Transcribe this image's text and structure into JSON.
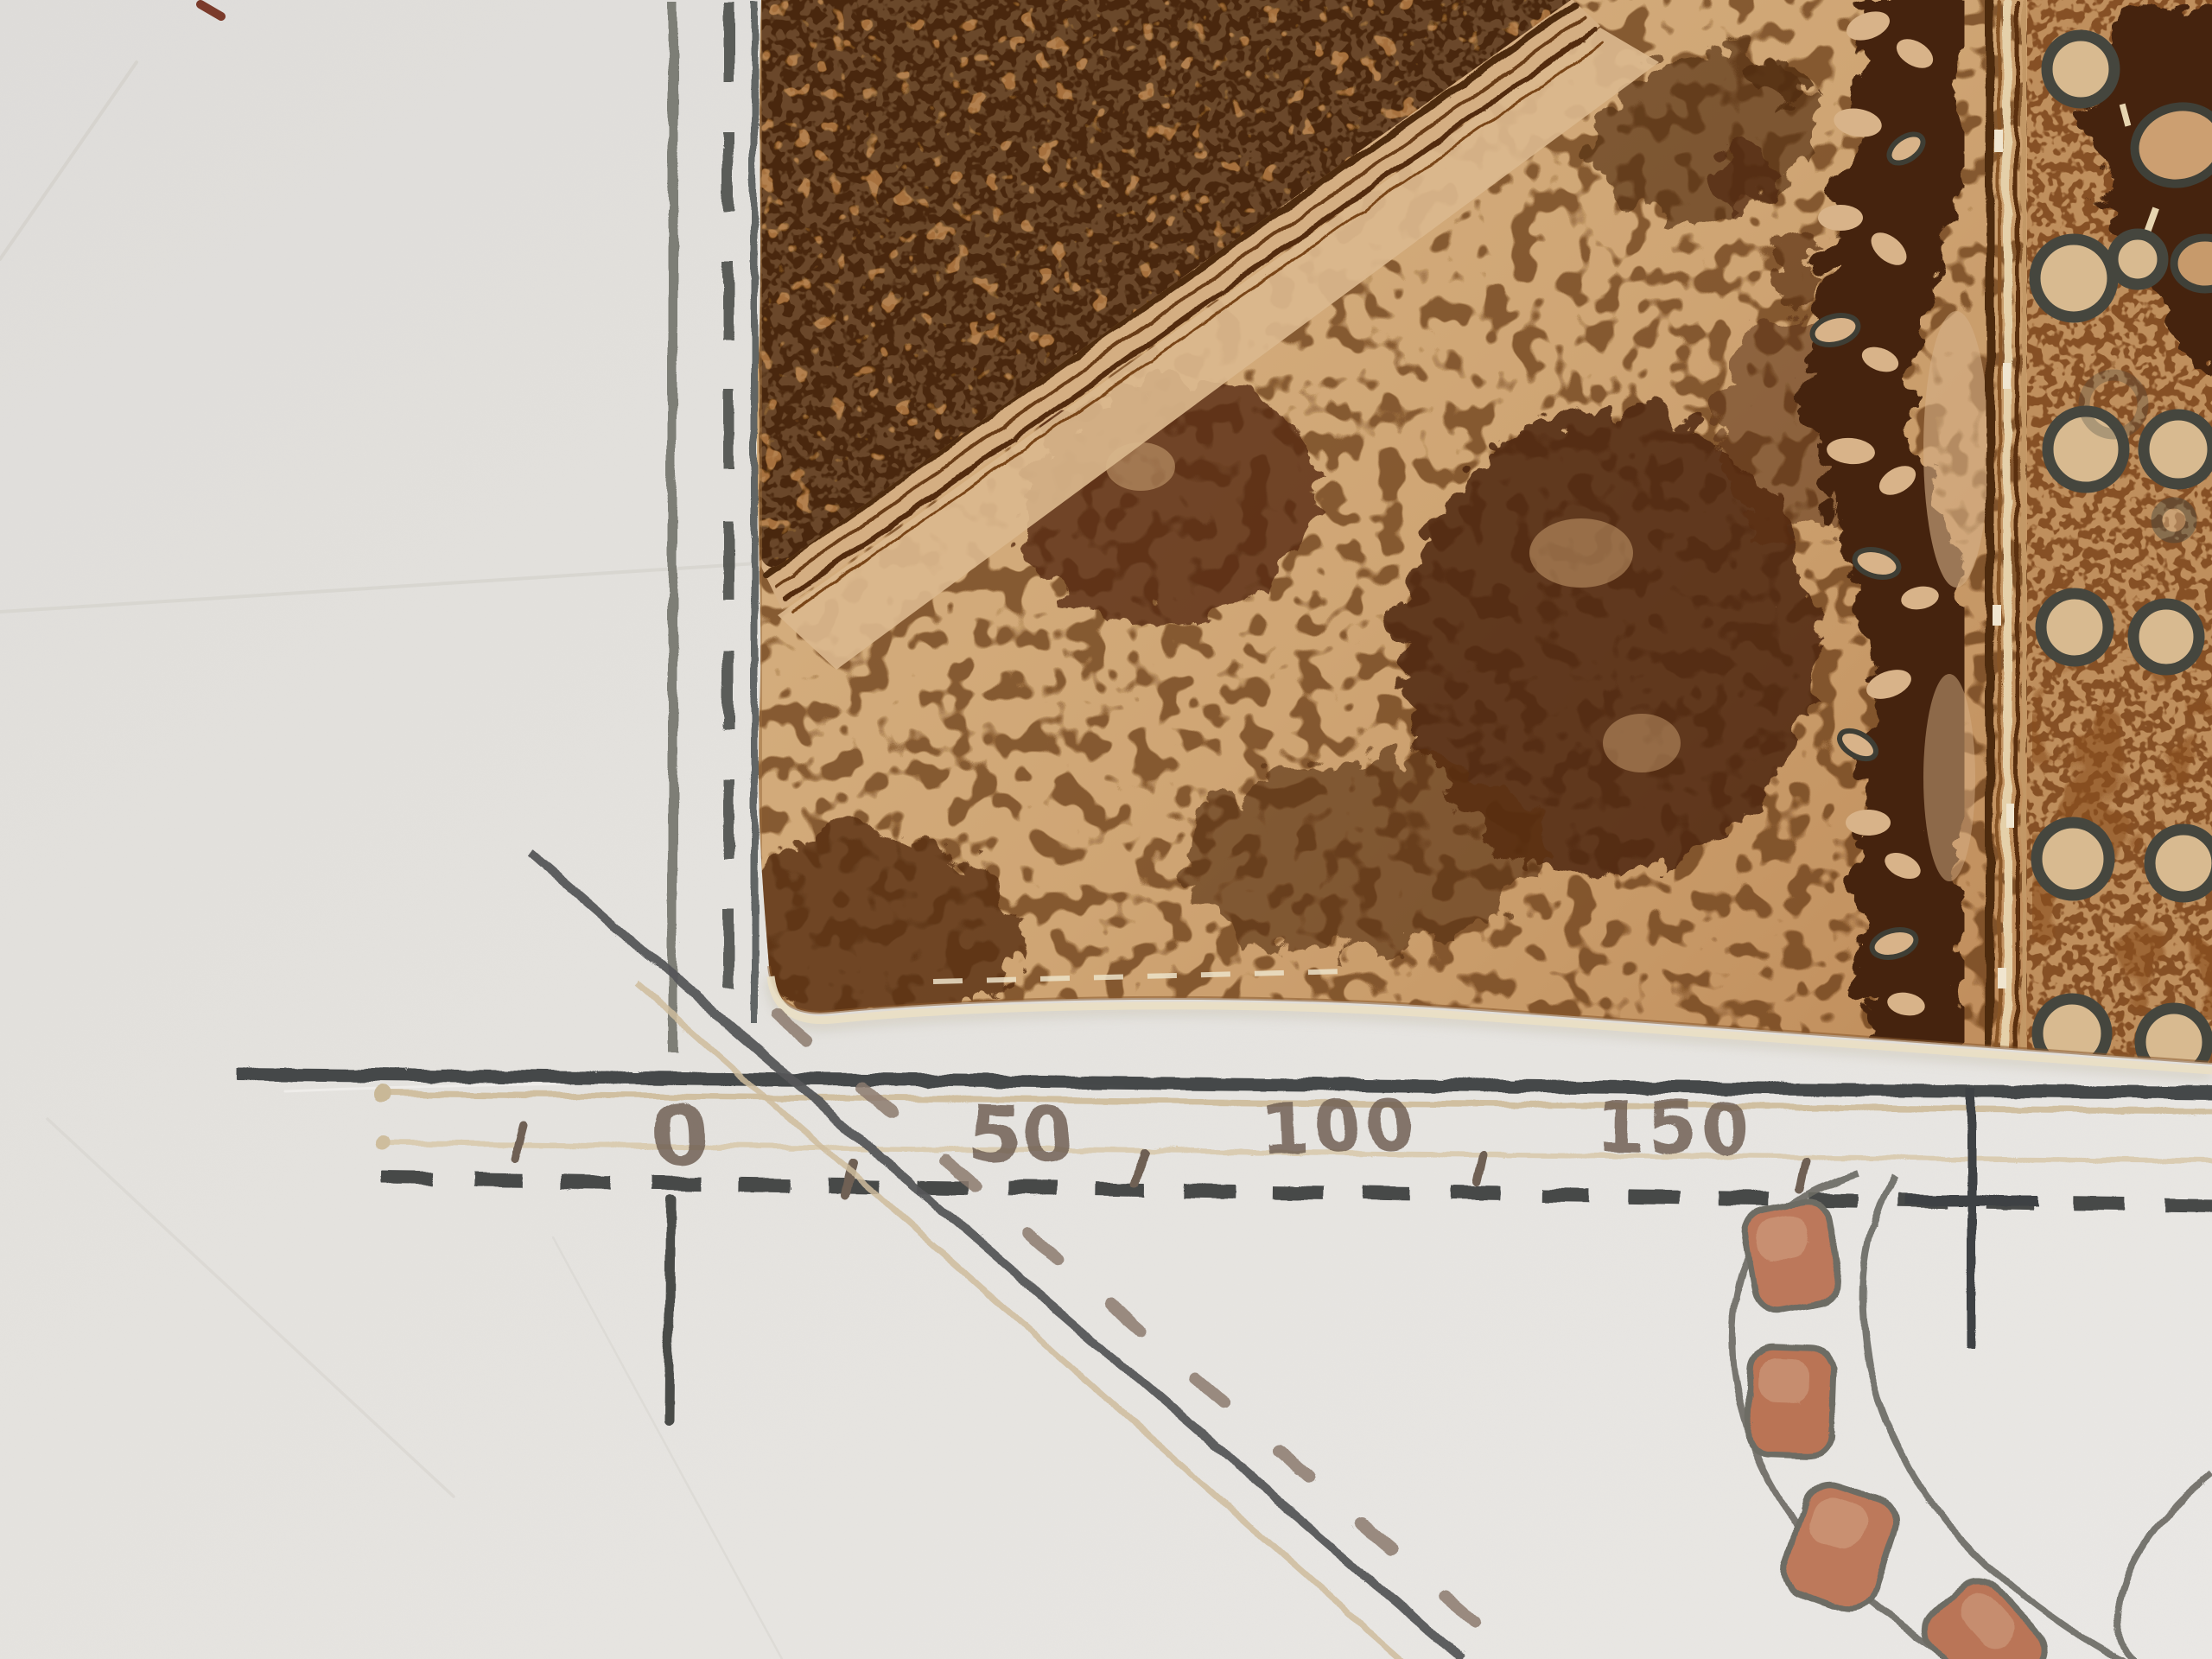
{
  "artwork": {
    "kind": "mixed-media etching map fragment",
    "scale_bar": {
      "labels": [
        "0",
        "50",
        "100",
        "150"
      ]
    },
    "palette": {
      "paper": "#e8e6e3",
      "graphite_dark": "#3f4245",
      "graphite_light": "#73746f",
      "taupe_dash": "#8d7b70",
      "emboss_tan": "#cfbd9b",
      "etch_dark": "#4e2a0d",
      "etch_mid": "#8a5526",
      "etch_tan": "#d2a878",
      "etch_light": "#dcb68c",
      "ring_ink": "#45463e",
      "brick": "#bf795b",
      "red_mark": "#7c3a2b"
    }
  }
}
